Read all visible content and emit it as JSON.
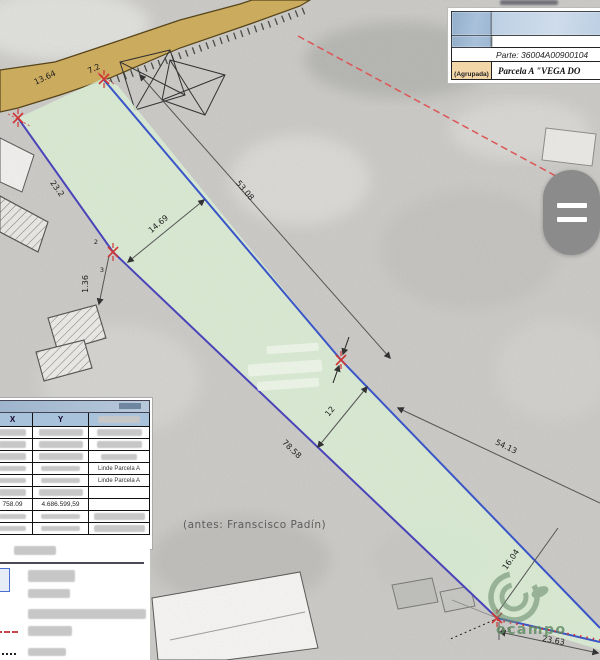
{
  "map": {
    "dims": {
      "road1": "13.64",
      "road2": "7.2",
      "upper1": "53.08",
      "upper2": "54.13",
      "width_top": "14.69",
      "width_mid": "12",
      "left1": "23.2",
      "left2": "1.36",
      "left3": "78.58",
      "bottom_diag": "16.04",
      "bottom_edge": "23.63",
      "bottom_small": "4.5"
    },
    "vertex_labels": {
      "a": "2",
      "b": "3"
    },
    "annotation": "(antes: Franscisco Padín)",
    "watermark_text": "ocampo"
  },
  "info_panel": {
    "parte": "Parte: 36004A00900104",
    "agrupada": "(Agrupada)",
    "parcela": "Parcela A \"VEGA DO"
  },
  "coords_panel": {
    "col_x": "X",
    "col_y": "Y",
    "linde_label": "Linde Parcela A",
    "x_value": "758.09",
    "y_value": "4.686.599,59"
  },
  "colors": {
    "parcel_green": "#d7ead2",
    "boundary_blue": "#3a55c8",
    "boundary_purple": "#4a44b8",
    "marker_red": "#d03333",
    "dashed_red": "#dd5555",
    "road_tan": "#cbab5e",
    "logo_green": "#6e8f72",
    "table_header_blue": "#a8c2dc",
    "agrupada_peach": "#f3d6a8"
  }
}
